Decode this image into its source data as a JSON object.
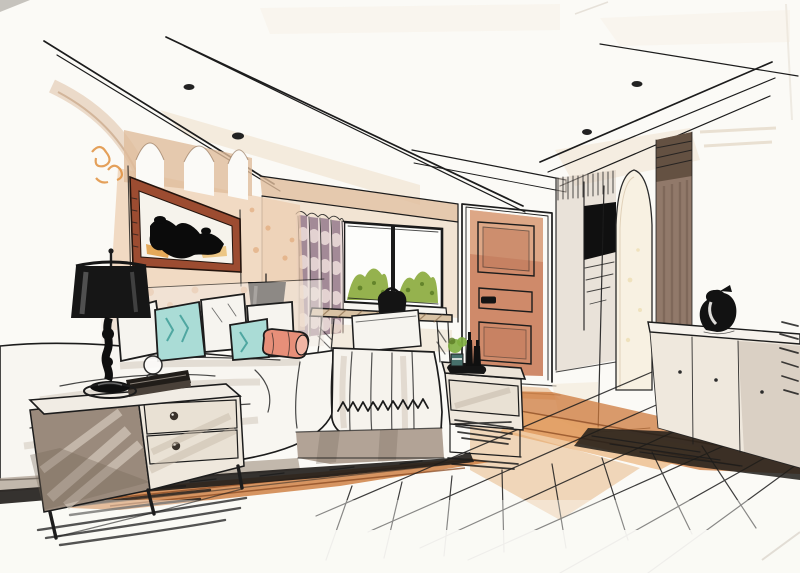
{
  "scene": {
    "medium": "hand-drawn marker and watercolor rendering",
    "subject": "bedroom interior sketch in two-point perspective",
    "room": "bedroom with tray ceiling, picture window, terracotta door and plank wood floor"
  },
  "palette": {
    "paper": "#fbfaf6",
    "ink": "#1c1c1c",
    "wall_peach": "#ecccae",
    "arch_tan": "#e0bd9c",
    "accent_orange": "#e0913f",
    "art_frame_wood": "#9c4c31",
    "art_black": "#0b0b0b",
    "curtain_mauve": "#9c8290",
    "curtain_blush": "#eadad8",
    "window_green": "#8fae44",
    "greenery_dark": "#5c7d26",
    "sill_white": "#f7f5f0",
    "door_terracotta": "#cf8a6a",
    "door_panel": "#c07a5c",
    "column_brown": "#91796a",
    "column_dark": "#5f4c3e",
    "wardrobe_black": "#101010",
    "niche_cream": "#f8f1e2",
    "furniture_cream": "#efe8dd",
    "furniture_taupe": "#9a8a7c",
    "desk_wood": "#d8c2a4",
    "pillow_aqua": "#aadcd6",
    "pillow_coral": "#e78f79",
    "bedding_white": "#f8f6f1",
    "bed_base_taupe": "#b2a396",
    "floor_orange": "#cd7a3c",
    "floor_orange_light": "#e9a967",
    "shadow_black": "#1f1c19",
    "lamp_black": "#161616",
    "vase_black": "#121212",
    "plant_pot_teal": "#47706b",
    "far_wall_tan": "#ecd9c0"
  },
  "objects": [
    "tray ceiling with four recessed spotlights",
    "sloping perspective ceiling beams",
    "abstract black artwork in wood frame",
    "arched plaster niches on headboard wall",
    "black drum-shade table lamp",
    "small black bedside lamp",
    "chest-of-drawers nightstand with round knobs",
    "stack of books and round glass",
    "bed with white duvet",
    "aqua and white throw pillows",
    "coral bolster pillow",
    "fringed throw blanket with zigzag border",
    "striped mauve curtain panel",
    "picture window with garden greenery",
    "writing desk with chair and black bag",
    "paneled terracotta door",
    "dark media wardrobe niche",
    "arched alcove",
    "wood pilaster column",
    "low white sideboard with black vase",
    "end table with plant, bottles and tray",
    "orange-stained plank wood floor"
  ]
}
